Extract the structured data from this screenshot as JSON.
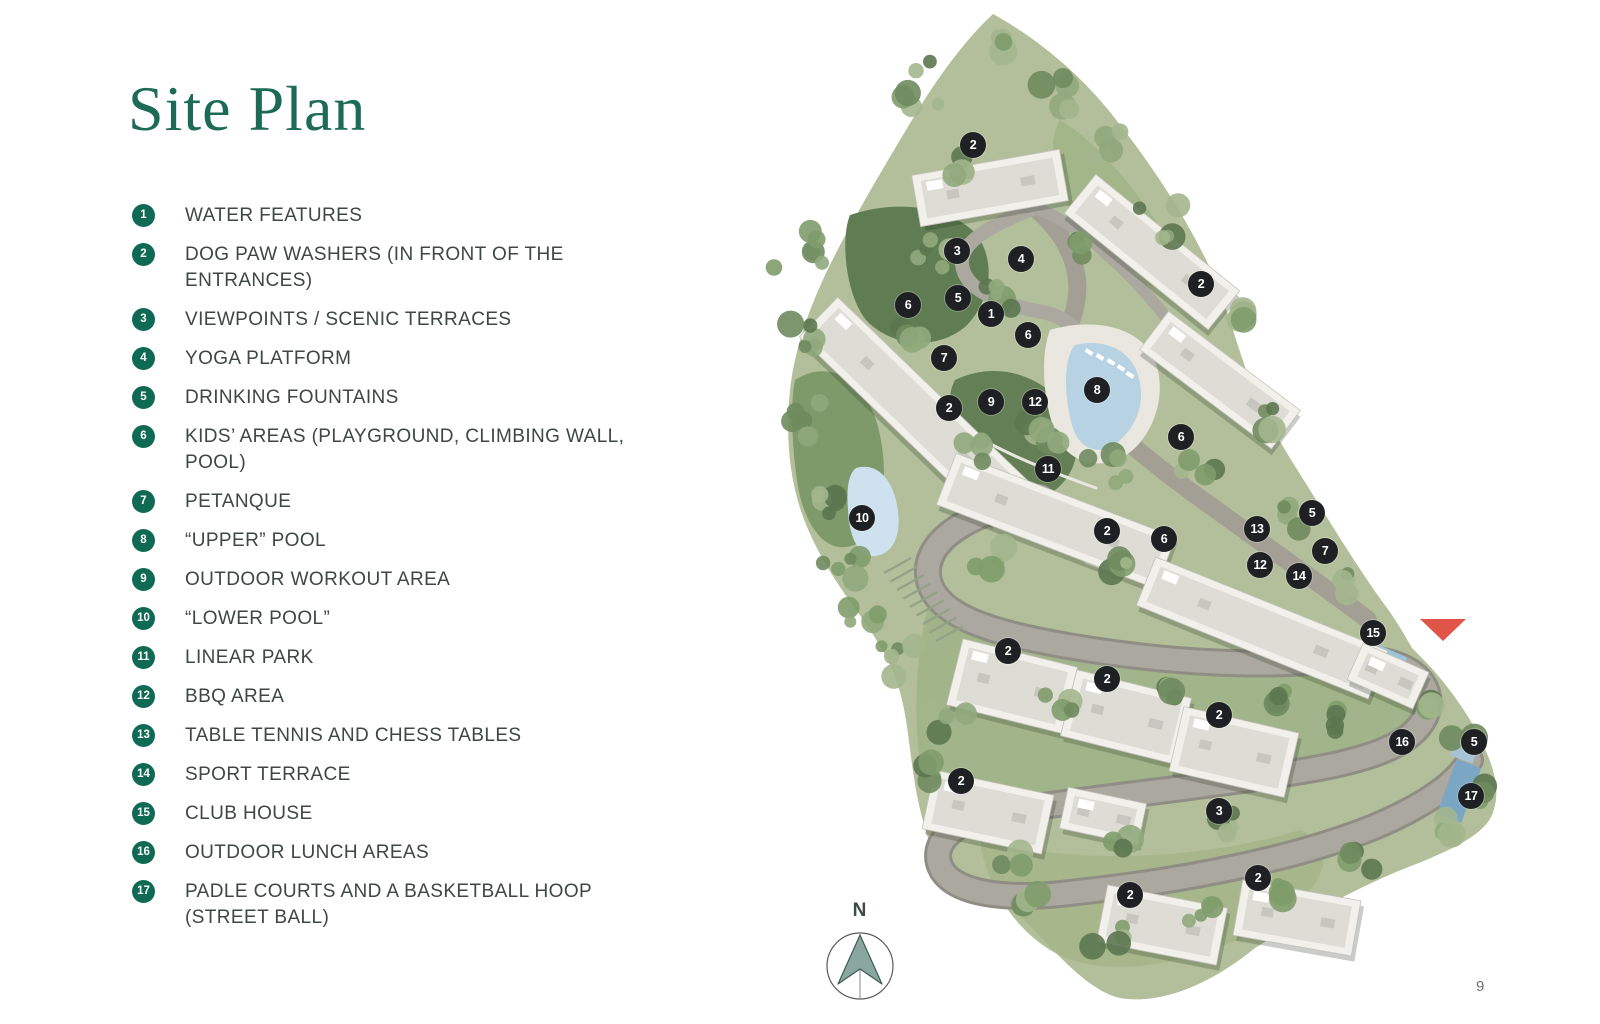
{
  "page": {
    "title": "Site Plan",
    "page_number": "9"
  },
  "legend": {
    "items": [
      {
        "num": "1",
        "label": "WATER FEATURES"
      },
      {
        "num": "2",
        "label": "DOG PAW WASHERS (IN FRONT OF THE ENTRANCES)"
      },
      {
        "num": "3",
        "label": "VIEWPOINTS / SCENIC TERRACES"
      },
      {
        "num": "4",
        "label": "YOGA PLATFORM"
      },
      {
        "num": "5",
        "label": "DRINKING FOUNTAINS"
      },
      {
        "num": "6",
        "label": "KIDS’ AREAS (PLAYGROUND, CLIMBING WALL, POOL)"
      },
      {
        "num": "7",
        "label": "PETANQUE"
      },
      {
        "num": "8",
        "label": "“UPPER” POOL"
      },
      {
        "num": "9",
        "label": "OUTDOOR WORKOUT AREA"
      },
      {
        "num": "10",
        "label": "“LOWER POOL”"
      },
      {
        "num": "11",
        "label": "LINEAR PARK"
      },
      {
        "num": "12",
        "label": "BBQ AREA"
      },
      {
        "num": "13",
        "label": "TABLE TENNIS AND CHESS TABLES"
      },
      {
        "num": "14",
        "label": "SPORT TERRACE"
      },
      {
        "num": "15",
        "label": "CLUB HOUSE"
      },
      {
        "num": "16",
        "label": "OUTDOOR LUNCH AREAS"
      },
      {
        "num": "17",
        "label": "PADLE COURTS AND A BASKETBALL HOOP (STREET BALL)"
      }
    ]
  },
  "compass": {
    "label": "N"
  },
  "map": {
    "markers": [
      {
        "n": "2",
        "x": 973,
        "y": 145
      },
      {
        "n": "3",
        "x": 957,
        "y": 251
      },
      {
        "n": "4",
        "x": 1021,
        "y": 259
      },
      {
        "n": "2",
        "x": 1201,
        "y": 284
      },
      {
        "n": "5",
        "x": 958,
        "y": 298
      },
      {
        "n": "6",
        "x": 908,
        "y": 305
      },
      {
        "n": "1",
        "x": 991,
        "y": 314
      },
      {
        "n": "6",
        "x": 1028,
        "y": 335
      },
      {
        "n": "7",
        "x": 944,
        "y": 358
      },
      {
        "n": "8",
        "x": 1097,
        "y": 390
      },
      {
        "n": "9",
        "x": 991,
        "y": 402
      },
      {
        "n": "12",
        "x": 1035,
        "y": 402
      },
      {
        "n": "2",
        "x": 949,
        "y": 408
      },
      {
        "n": "6",
        "x": 1181,
        "y": 437
      },
      {
        "n": "11",
        "x": 1048,
        "y": 469
      },
      {
        "n": "5",
        "x": 1312,
        "y": 513
      },
      {
        "n": "10",
        "x": 862,
        "y": 518
      },
      {
        "n": "13",
        "x": 1257,
        "y": 529
      },
      {
        "n": "2",
        "x": 1107,
        "y": 531
      },
      {
        "n": "6",
        "x": 1164,
        "y": 539
      },
      {
        "n": "7",
        "x": 1325,
        "y": 551
      },
      {
        "n": "12",
        "x": 1260,
        "y": 565
      },
      {
        "n": "14",
        "x": 1299,
        "y": 576
      },
      {
        "n": "15",
        "x": 1373,
        "y": 633
      },
      {
        "n": "2",
        "x": 1008,
        "y": 651
      },
      {
        "n": "2",
        "x": 1107,
        "y": 679
      },
      {
        "n": "2",
        "x": 1219,
        "y": 715
      },
      {
        "n": "16",
        "x": 1402,
        "y": 742
      },
      {
        "n": "5",
        "x": 1474,
        "y": 742
      },
      {
        "n": "2",
        "x": 961,
        "y": 781
      },
      {
        "n": "17",
        "x": 1471,
        "y": 796
      },
      {
        "n": "3",
        "x": 1219,
        "y": 811
      },
      {
        "n": "2",
        "x": 1258,
        "y": 878
      },
      {
        "n": "2",
        "x": 1130,
        "y": 895
      }
    ],
    "location_pointer": {
      "x": 1443,
      "y": 630
    }
  },
  "colors": {
    "title_green": "#1d6b57",
    "badge_green": "#0f6a53",
    "legend_text": "#3f4643",
    "marker_bg": "#1f2023",
    "marker_text": "#ffffff",
    "location_red": "#e05548",
    "land_green": "#b2bf9a",
    "road_gray": "#a8a69d",
    "pool_blue": "#b7d2e3",
    "compass_fill": "#8aa79f"
  }
}
